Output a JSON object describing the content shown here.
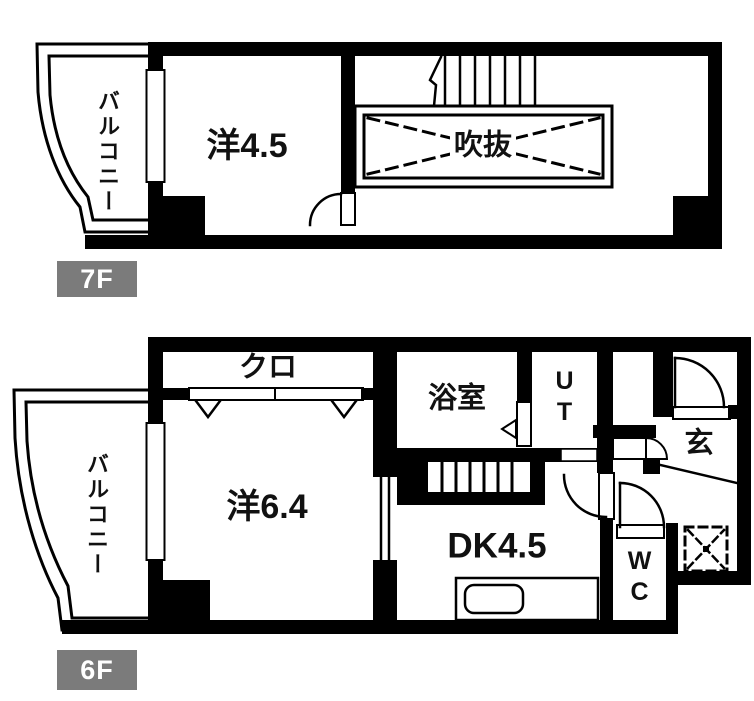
{
  "floorplan": {
    "floors": [
      {
        "label": "7F",
        "rooms": {
          "balcony": "バルコニー",
          "western_room": "洋4.5",
          "void": "吹抜"
        }
      },
      {
        "label": "6F",
        "rooms": {
          "balcony": "バルコニー",
          "closet": "クロ",
          "western_room": "洋6.4",
          "bathroom": "浴室",
          "utility": "UT",
          "entrance": "玄",
          "dining_kitchen": "DK4.5",
          "toilet": "WC"
        }
      }
    ],
    "colors": {
      "wall": "#000000",
      "floor_label_bg": "#7b7b7b",
      "floor_label_text": "#ffffff"
    }
  }
}
